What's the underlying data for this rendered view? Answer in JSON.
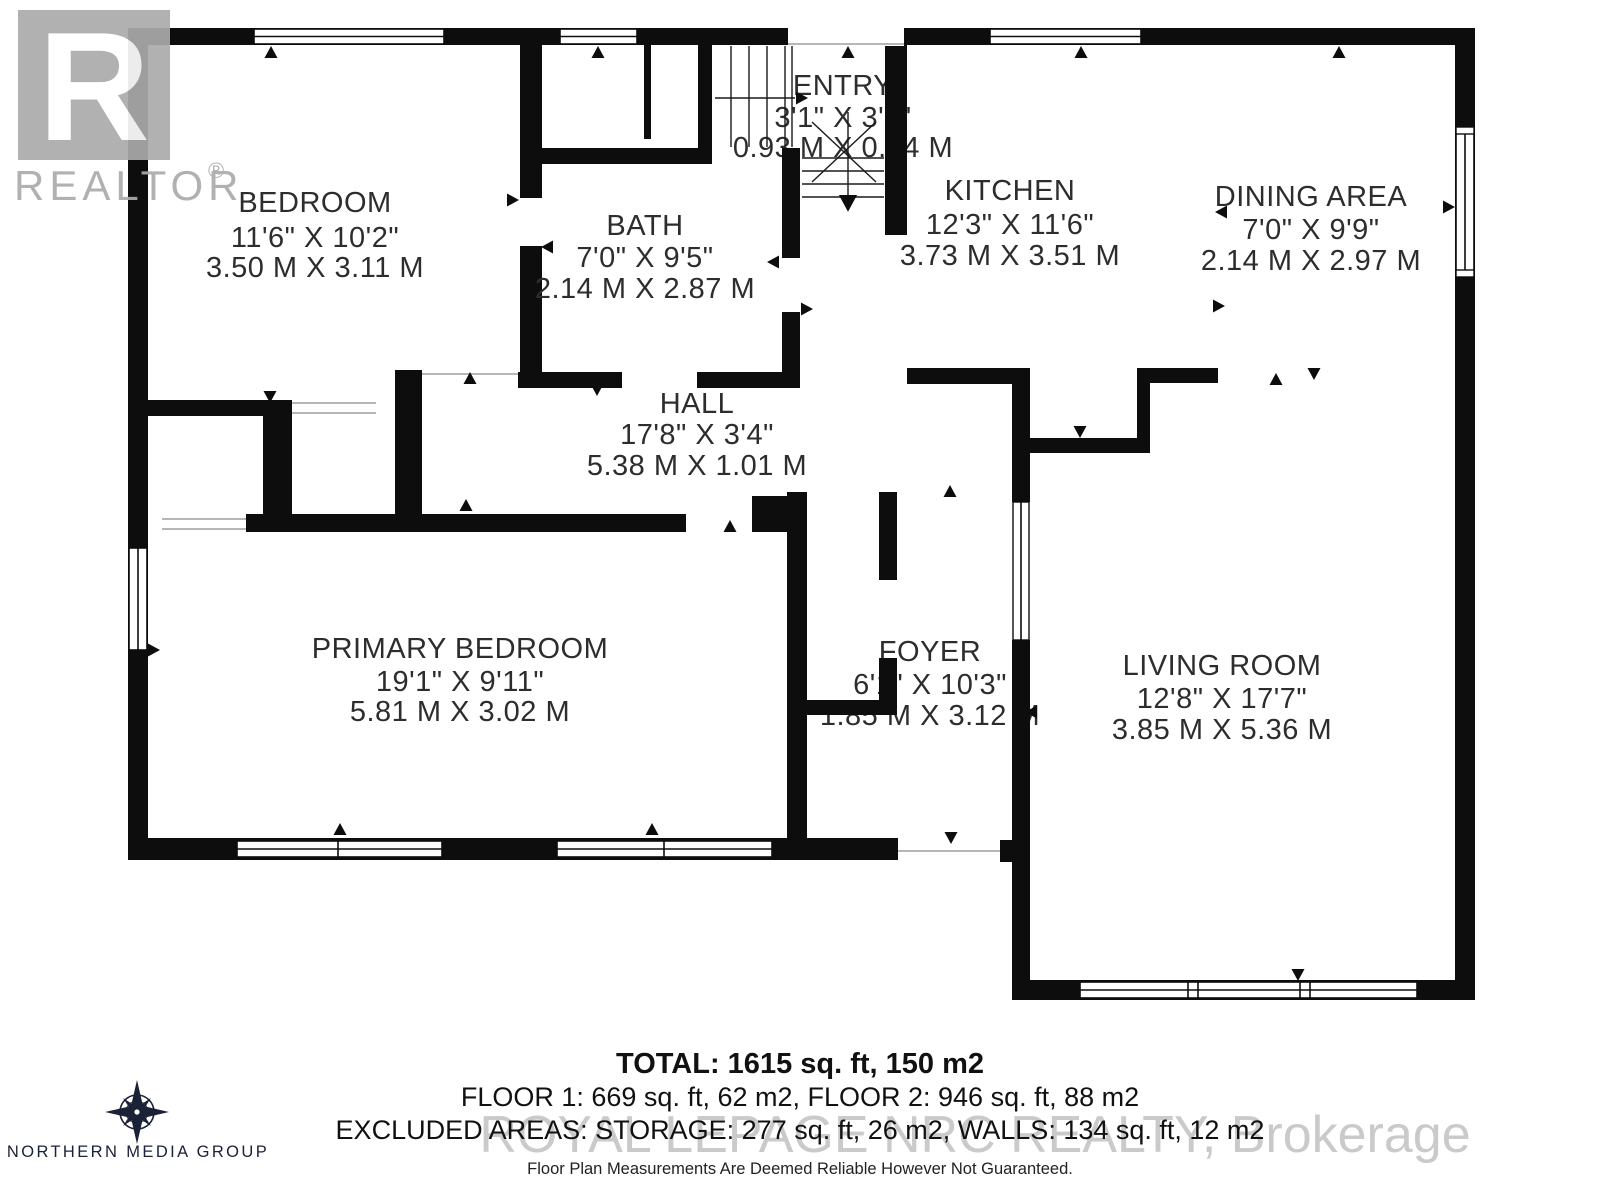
{
  "branding": {
    "realtor_r": "R",
    "realtor_wordmark": "REALTOR",
    "realtor_reg": "®",
    "media_group_name": "NORTHERN MEDIA GROUP",
    "watermark_text": "ROYAL LEPAGE NRC REALTY, Brokerage"
  },
  "rooms": [
    {
      "id": "bedroom",
      "name": "BEDROOM",
      "imperial": "11'6\" X 10'2\"",
      "metric": "3.50 M X 3.11 M"
    },
    {
      "id": "bath",
      "name": "BATH",
      "imperial": "7'0\" X 9'5\"",
      "metric": "2.14 M X 2.87 M"
    },
    {
      "id": "entry",
      "name": "ENTRY",
      "imperial": "3'1\" X 3'1\"",
      "metric": "0.93 M X 0.94 M"
    },
    {
      "id": "kitchen",
      "name": "KITCHEN",
      "imperial": "12'3\" X 11'6\"",
      "metric": "3.73 M X 3.51 M"
    },
    {
      "id": "dining",
      "name": "DINING AREA",
      "imperial": "7'0\" X 9'9\"",
      "metric": "2.14 M X 2.97 M"
    },
    {
      "id": "hall",
      "name": "HALL",
      "imperial": "17'8\" X 3'4\"",
      "metric": "5.38 M X 1.01 M"
    },
    {
      "id": "primary",
      "name": "PRIMARY BEDROOM",
      "imperial": "19'1\" X 9'11\"",
      "metric": "5.81 M X 3.02 M"
    },
    {
      "id": "foyer",
      "name": "FOYER",
      "imperial": "6'1\" X 10'3\"",
      "metric": "1.85 M X 3.12 M"
    },
    {
      "id": "living",
      "name": "LIVING ROOM",
      "imperial": "12'8\" X 17'7\"",
      "metric": "3.85 M X 5.36 M"
    }
  ],
  "summary": {
    "total": "TOTAL: 1615 sq. ft, 150 m2",
    "floors": "FLOOR 1: 669 sq. ft, 62 m2, FLOOR 2: 946 sq. ft, 88 m2",
    "excluded": "EXCLUDED AREAS: STORAGE: 277 sq. ft, 26 m2, WALLS: 134 sq. ft, 12 m2",
    "disclaimer": "Floor Plan Measurements Are Deemed Reliable However Not Guaranteed."
  },
  "colors": {
    "wall": "#0d0d0d",
    "label": "#2d2d2d",
    "watermark": "#bdbdbd"
  }
}
